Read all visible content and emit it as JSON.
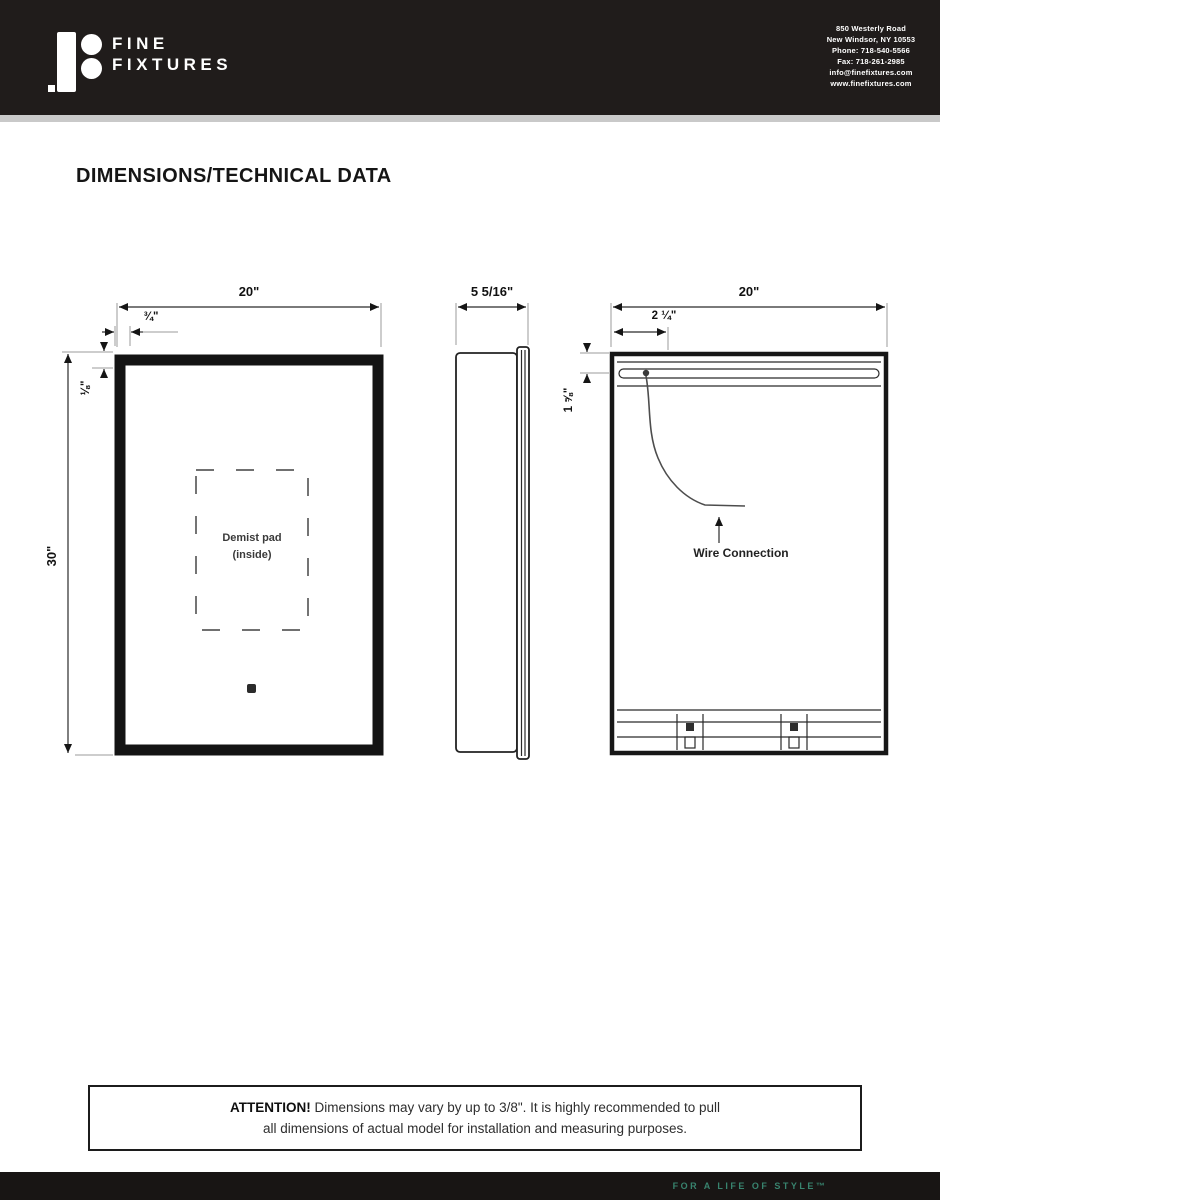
{
  "header": {
    "brand": {
      "line1": "FINE",
      "line2": "FIXTURES"
    },
    "address_lines": [
      "850 Westerly Road",
      "New Windsor, NY 10553",
      "Phone: 718-540-5566",
      "Fax: 718-261-2985",
      "info@finefixtures.com",
      "www.finefixtures.com"
    ]
  },
  "title": "DIMENSIONS/TECHNICAL DATA",
  "drawings": {
    "front_view": {
      "width": "20\"",
      "frame": "¾\"",
      "inset": "⅛\"",
      "height": "30\"",
      "demist_line1": "Demist pad",
      "demist_line2": "(inside)"
    },
    "side_view": {
      "depth": "5 5/16\""
    },
    "back_view": {
      "width": "20\"",
      "wire_offset": "2 ¼\"",
      "rail_offset": "1 ⅝\"",
      "wire_label": "Wire Connection"
    }
  },
  "attention": {
    "heading": "ATTENTION!",
    "line1": "Dimensions may vary by up to 3/8\". It is highly recommended to pull",
    "line2": "all dimensions of actual model for installation and measuring purposes."
  },
  "footer": {
    "tagline": "FOR A LIFE OF STYLE™"
  },
  "colors": {
    "header_bg": "#201c1b",
    "footer_bg": "#181514",
    "tagline": "#38836e",
    "line": "#1a1a1a"
  }
}
